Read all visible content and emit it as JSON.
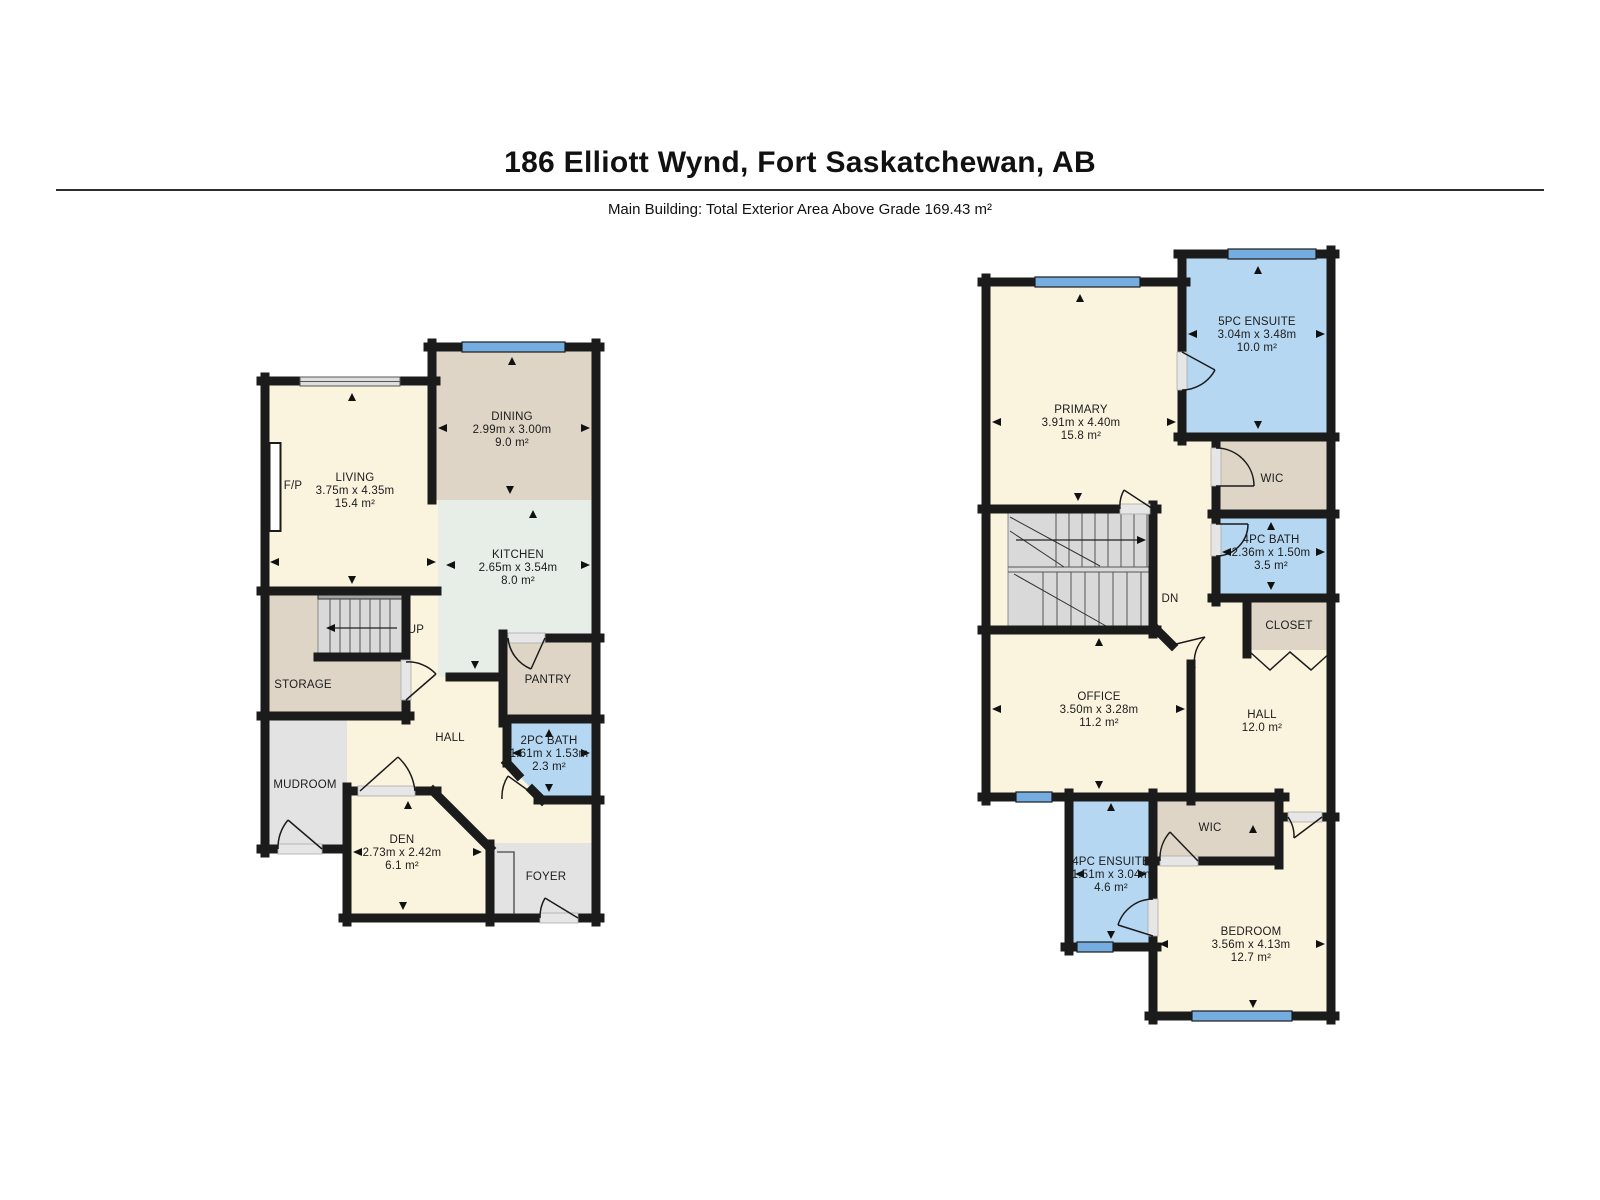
{
  "page": {
    "title": "186 Elliott Wynd, Fort Saskatchewan, AB",
    "subtitle": "Main Building: Total Exterior Area Above Grade 169.43 m²"
  },
  "colors": {
    "wall": "#1b1b1b",
    "room_cream": "#faf3de",
    "room_tan": "#ded5c6",
    "room_mint": "#e7eee8",
    "room_gray": "#e3e3e3",
    "room_blue": "#b5d7f1",
    "window_blue": "#76ade0",
    "stairs_gray": "#d9d9d9"
  },
  "floors": {
    "main": {
      "rooms": {
        "living": {
          "name": "LIVING",
          "dims": "3.75m x 4.35m",
          "area": "15.4 m²"
        },
        "dining": {
          "name": "DINING",
          "dims": "2.99m x 3.00m",
          "area": "9.0 m²"
        },
        "kitchen": {
          "name": "KITCHEN",
          "dims": "2.65m x 3.54m",
          "area": "8.0 m²"
        },
        "pantry": {
          "name": "PANTRY"
        },
        "bath2pc": {
          "name": "2PC BATH",
          "dims": "1.61m x 1.53m",
          "area": "2.3 m²"
        },
        "den": {
          "name": "DEN",
          "dims": "2.73m x 2.42m",
          "area": "6.1 m²"
        },
        "storage": {
          "name": "STORAGE"
        },
        "mudroom": {
          "name": "MUDROOM"
        },
        "hall": {
          "name": "HALL"
        },
        "foyer": {
          "name": "FOYER"
        }
      },
      "labels": {
        "fireplace": "F/P",
        "stairs": "UP"
      }
    },
    "upper": {
      "rooms": {
        "primary": {
          "name": "PRIMARY",
          "dims": "3.91m x 4.40m",
          "area": "15.8 m²"
        },
        "ensuite5pc": {
          "name": "5PC ENSUITE",
          "dims": "3.04m x 3.48m",
          "area": "10.0 m²"
        },
        "wic_upper": {
          "name": "WIC"
        },
        "bath4pc": {
          "name": "4PC BATH",
          "dims": "2.36m x 1.50m",
          "area": "3.5 m²"
        },
        "closet": {
          "name": "CLOSET"
        },
        "office": {
          "name": "OFFICE",
          "dims": "3.50m x 3.28m",
          "area": "11.2 m²"
        },
        "hall": {
          "name": "HALL",
          "area": "12.0 m²"
        },
        "wic_lower": {
          "name": "WIC"
        },
        "ensuite4pc": {
          "name": "4PC ENSUITE",
          "dims": "1.51m x 3.04m",
          "area": "4.6 m²"
        },
        "bedroom": {
          "name": "BEDROOM",
          "dims": "3.56m x 4.13m",
          "area": "12.7 m²"
        }
      },
      "labels": {
        "stairs": "DN"
      }
    }
  }
}
